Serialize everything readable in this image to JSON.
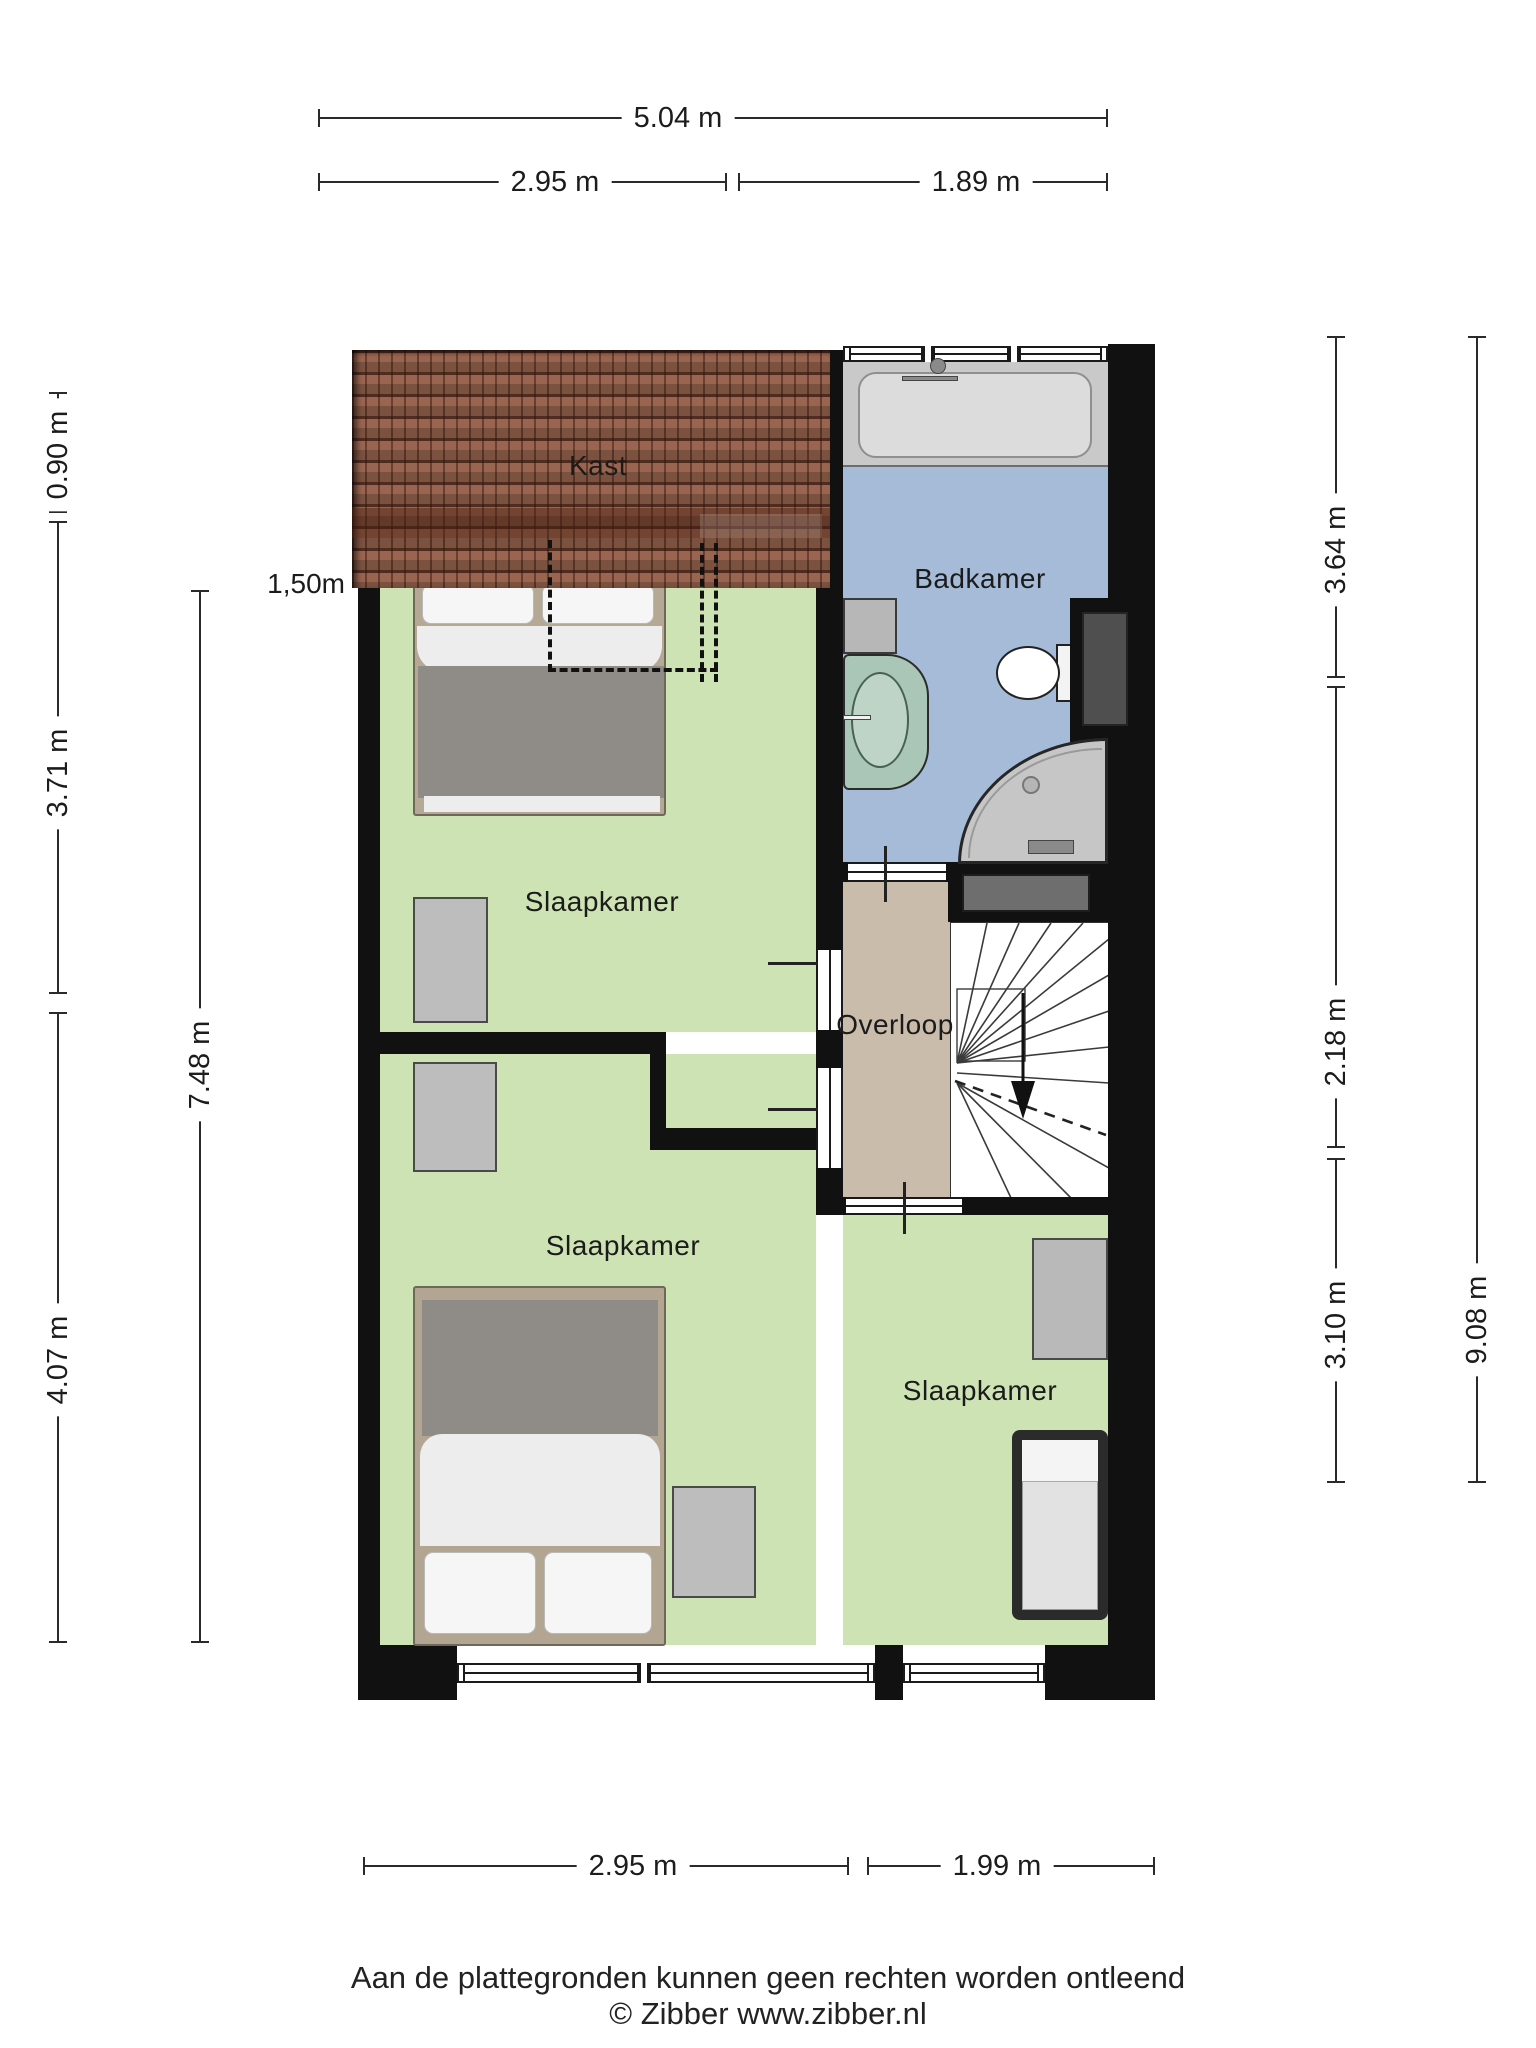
{
  "floorplan": {
    "rooms": [
      {
        "label": "Kast"
      },
      {
        "label": "Badkamer"
      },
      {
        "label": "Slaapkamer"
      },
      {
        "label": "Overloop"
      },
      {
        "label": "Slaapkamer"
      },
      {
        "label": "Slaapkamer"
      }
    ],
    "annotation_headroom": "1,50m"
  },
  "dimensions": {
    "top": [
      "5.04 m",
      "2.95 m",
      "1.89 m"
    ],
    "bottom": [
      "2.95 m",
      "1.99 m"
    ],
    "left": [
      "0.90 m",
      "3.71 m",
      "4.07 m",
      "7.48 m"
    ],
    "right": [
      "3.64 m",
      "2.18 m",
      "3.10 m",
      "9.08 m"
    ]
  },
  "footer": {
    "disclaimer": "Aan de plattegronden kunnen geen rechten worden ontleend",
    "copyright": "© Zibber www.zibber.nl"
  },
  "colors": {
    "floor_bedroom": "#cde3b4",
    "floor_bathroom": "#a6bbd8",
    "floor_landing": "#c9bcaa",
    "roof": "#9a6550",
    "wall": "#111111"
  }
}
